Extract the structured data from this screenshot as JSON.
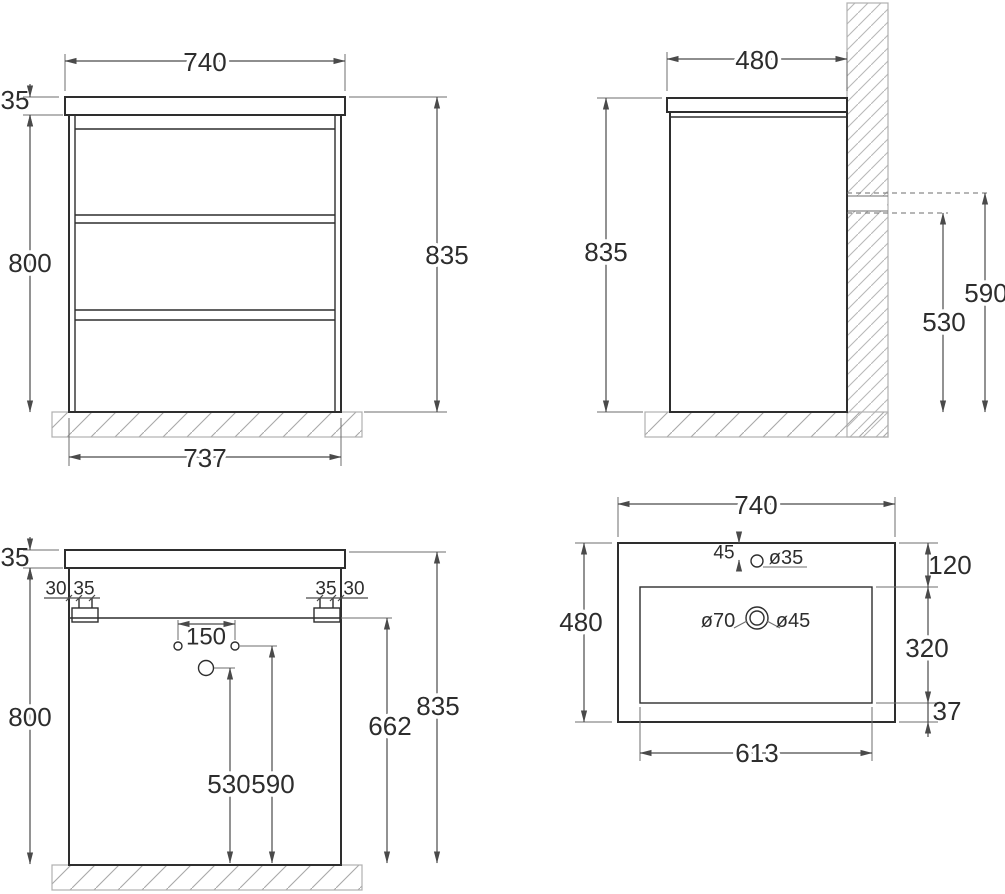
{
  "drawing": {
    "type": "technical-drawing",
    "subject": "bathroom vanity cabinet with sink, four orthographic views",
    "line_color": "#2e2e2e",
    "dim_color": "#4a4a4a",
    "background": "#ffffff"
  },
  "views": {
    "front": {
      "label": "front-view",
      "dims": {
        "top_width": "740",
        "countertop_thickness": "35",
        "body_height": "800",
        "overall_height": "835",
        "bottom_width": "737"
      }
    },
    "side": {
      "label": "side-view",
      "dims": {
        "depth": "480",
        "overall_height": "835",
        "upper_outlet_height": "590",
        "lower_outlet_height": "530"
      }
    },
    "back": {
      "label": "back-view",
      "dims": {
        "countertop_thickness": "35",
        "left_edge_offset": "30",
        "left_bracket_width": "35",
        "right_bracket_width": "35",
        "right_edge_offset": "30",
        "hole_spacing": "150",
        "body_height": "800",
        "drain_hole_height": "530",
        "supply_holes_height": "590",
        "bracket_height": "662",
        "overall_height": "835"
      }
    },
    "sink": {
      "label": "sink-top-view",
      "dims": {
        "width": "740",
        "depth": "480",
        "faucet_offset": "45",
        "faucet_hole_dia": "ø35",
        "overflow_dia": "ø70",
        "drain_dia": "ø45",
        "back_margin": "120",
        "basin_depth": "320",
        "front_margin": "37",
        "basin_width": "613"
      }
    }
  }
}
